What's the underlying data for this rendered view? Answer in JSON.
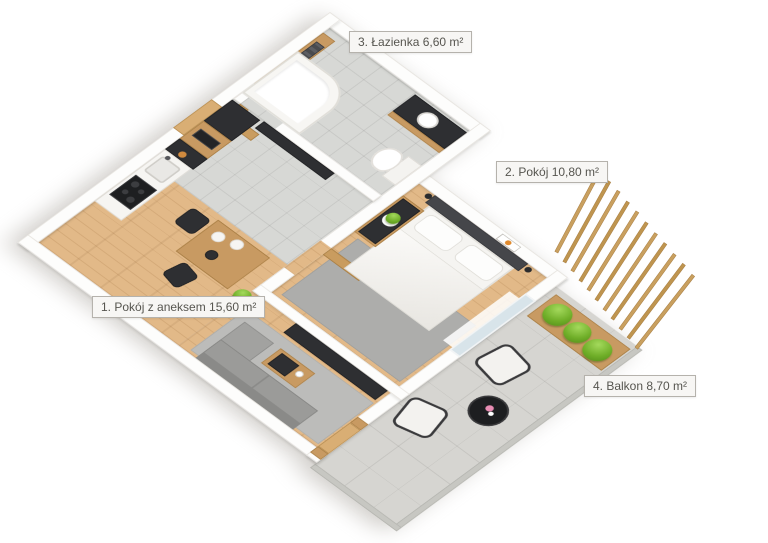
{
  "scene": {
    "type": "3d-isometric-floorplan-render",
    "background": "#ffffff"
  },
  "rooms": [
    {
      "number": "1.",
      "name": "Pokój z aneksem",
      "area": "15,60",
      "unit": "m²",
      "label": "1. Pokój z aneksem 15,60 m²"
    },
    {
      "number": "2.",
      "name": "Pokój",
      "area": "10,80",
      "unit": "m²",
      "label": "2. Pokój 10,80 m²"
    },
    {
      "number": "3.",
      "name": "Łazienka",
      "area": "6,60",
      "unit": "m²",
      "label": "3. Łazienka 6,60 m²"
    },
    {
      "number": "4.",
      "name": "Balkon",
      "area": "8,70",
      "unit": "m²",
      "label": "4. Balkon 8,70 m²"
    }
  ],
  "colors": {
    "wall": "#fdfdfc",
    "wood_cabinet": "#c89a62",
    "wood_floor": "#e2b988",
    "tile_floor": "#d7d8d5",
    "concrete_floor": "#d6d5d1",
    "dark_furniture": "#2e2f32",
    "sofa_gray": "#9b9b99",
    "plant_green": "#6fae28",
    "label_border": "#b5b2ac",
    "label_text": "#56554f",
    "label_bg": "#f7f6f4"
  }
}
